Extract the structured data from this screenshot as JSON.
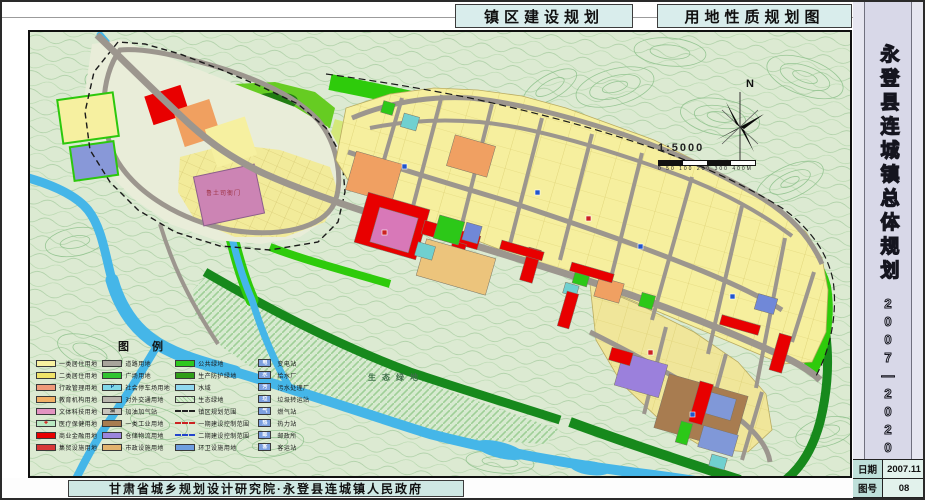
{
  "header": {
    "title_left": "镇区建设规划",
    "title_right": "用地性质规划图"
  },
  "sidebar": {
    "title": "永登县连城镇总体规划",
    "years": "2007—2020",
    "info_rows": [
      {
        "label": "日期",
        "value": "2007.11"
      },
      {
        "label": "图号",
        "value": "08"
      }
    ]
  },
  "footer": {
    "credit": "甘肃省城乡规划设计研究院·永登县连城镇人民政府"
  },
  "map": {
    "north_label": "N",
    "scale_text": "1:5000",
    "scale_bar_label": "0 50 100 200 300 400M",
    "labels": {
      "eco_green": "生态绿地",
      "heritage": "鲁土司衙门"
    }
  },
  "legend": {
    "title": "图 例",
    "columns": [
      [
        {
          "label": "一类居住用地",
          "color": "#f8f2a0"
        },
        {
          "label": "二类居住用地",
          "color": "#f0e468"
        },
        {
          "label": "行政管理用地",
          "color": "#f09a7a"
        },
        {
          "label": "教育机构用地",
          "color": "#f2b066"
        },
        {
          "label": "文体科技用地",
          "color": "#e393c1"
        },
        {
          "label": "医疗保健用地",
          "color": "#b8e8c0",
          "glyph": "✚",
          "glyphColor": "#d80000"
        },
        {
          "label": "商业金融用地",
          "color": "#e80000"
        },
        {
          "label": "集贸设施用地",
          "color": "#d83838"
        }
      ],
      [
        {
          "label": "道路用地",
          "color": "#a8a49c"
        },
        {
          "label": "广场用地",
          "color": "#30c430"
        },
        {
          "label": "社会停车场用地",
          "color": "#80d8e8",
          "glyph": "P",
          "glyphColor": "#003f88"
        },
        {
          "label": "对外交通用地",
          "color": "#b8b4ac"
        },
        {
          "label": "加油加气站",
          "color": "#c8c4bc",
          "glyph": "油",
          "glyphColor": "#333333"
        },
        {
          "label": "一类工业用地",
          "color": "#a87c50"
        },
        {
          "label": "仓储物流用地",
          "color": "#9b85dc"
        },
        {
          "label": "市政设施用地",
          "color": "#e2b36e"
        }
      ],
      [
        {
          "label": "公共绿地",
          "color": "#2ec81e"
        },
        {
          "label": "生产防护绿地",
          "color": "#2f9e18"
        },
        {
          "label": "水域",
          "color": "#8fd8ef"
        },
        {
          "label": "生态绿地",
          "type": "hatch"
        },
        {
          "label": "镇区规划范围",
          "type": "dash",
          "color": "#222222"
        },
        {
          "label": "一期建设控制范围",
          "type": "dash",
          "color": "#cc2222"
        },
        {
          "label": "二期建设控制范围",
          "type": "dash",
          "color": "#2244cc"
        },
        {
          "label": "环卫设施用地",
          "color": "#6f9fe0"
        }
      ],
      [
        {
          "label": "变电站",
          "type": "box",
          "glyph": "电",
          "glyphColor": "#ffffff"
        },
        {
          "label": "给水厂",
          "type": "box",
          "glyph": "水",
          "glyphColor": "#ffffff"
        },
        {
          "label": "污水处理厂",
          "type": "box",
          "glyph": "污",
          "glyphColor": "#ffffff"
        },
        {
          "label": "垃圾转运站",
          "type": "box",
          "glyph": "垃",
          "glyphColor": "#ffffff"
        },
        {
          "label": "燃气站",
          "type": "box",
          "glyph": "气",
          "glyphColor": "#ffffff"
        },
        {
          "label": "热力站",
          "type": "box",
          "glyph": "热",
          "glyphColor": "#ffffff"
        },
        {
          "label": "邮政所",
          "type": "box",
          "glyph": "邮",
          "glyphColor": "#ffffff"
        },
        {
          "label": "客运站",
          "type": "box",
          "glyph": "客",
          "glyphColor": "#ffffff"
        }
      ]
    ]
  },
  "colors": {
    "residential_yellow": "#f6ef9e",
    "commercial_red": "#e80000",
    "market_pink": "#d878b8",
    "admin_orange": "#f0a062",
    "industry_brown": "#a87c50",
    "warehouse_purple": "#9b80dc",
    "green_space": "#2ecb0b",
    "water_blue": "#45b6e8",
    "road_gray": "#9c968e",
    "hills_base": "#dcead2",
    "title_box_teal": "#d9edec",
    "sidebar_lavender": "#d8d8e8"
  }
}
